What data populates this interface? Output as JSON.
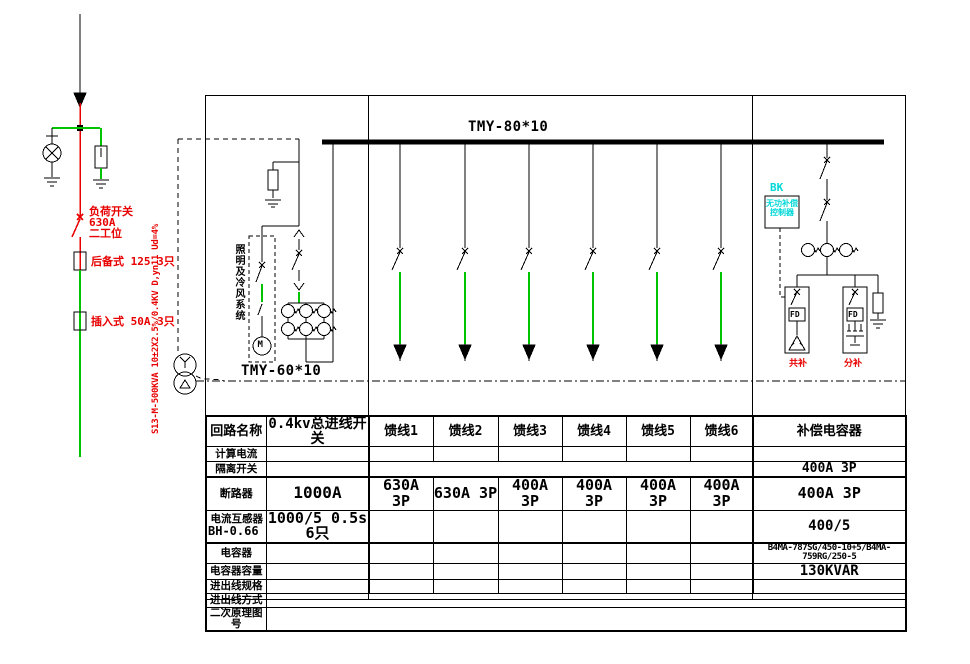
{
  "colors": {
    "line_green": "#00c400",
    "line_red": "#e80000",
    "text_red": "#e80000",
    "text_cyan": "#00d8d8",
    "line_black": "#000000"
  },
  "hv_feed": {
    "load_switch_line1": "负荷开关",
    "load_switch_line2": "630A",
    "load_switch_line3": "二工位",
    "fuse_backup_label": "后备式 125 3只",
    "fuse_plugin_label": "插入式 50A 3只",
    "transformer_spec": "S13-M-500KVA 10±2X2.5%/0.4KV D,yn11 Ud=4%"
  },
  "incoming_cabinet": {
    "branch_label": "照明及冷风系统",
    "motor_label": "M",
    "bus_label": "TMY-60*10"
  },
  "main_busbar_label": "TMY-80*10",
  "capacitor_bank": {
    "controller_tag": "BK",
    "controller_name_line1": "无功补偿",
    "controller_name_line2": "控制器",
    "contactor_label": "FD",
    "delta_branch_label": "共补",
    "split_branch_label": "分补"
  },
  "table": {
    "row_labels": [
      "回路名称",
      "计算电流",
      "隔离开关",
      "断路器",
      "电流互感器",
      "电容器",
      "电容器容量",
      "进出线规格",
      "进出线方式",
      "二次原理图号"
    ],
    "ct_row_label_line2": "BH-0.66",
    "circuits": [
      "0.4kv总进线开关",
      "馈线1",
      "馈线2",
      "馈线3",
      "馈线4",
      "馈线5",
      "馈线6",
      "补偿电容器"
    ],
    "isolator_cap_value": "400A 3P",
    "breaker_row": [
      "1000A",
      "630A 3P",
      "630A 3P",
      "400A 3P",
      "400A 3P",
      "400A 3P",
      "400A 3P",
      "400A 3P"
    ],
    "ct_incoming_value": "1000/5 0.5s 6只",
    "ct_cap_value": "400/5",
    "cap_model_value": "B4MA-787SG/450-10+5/B4MA-759RG/250-5",
    "cap_kvar_value": "130KVAR"
  }
}
